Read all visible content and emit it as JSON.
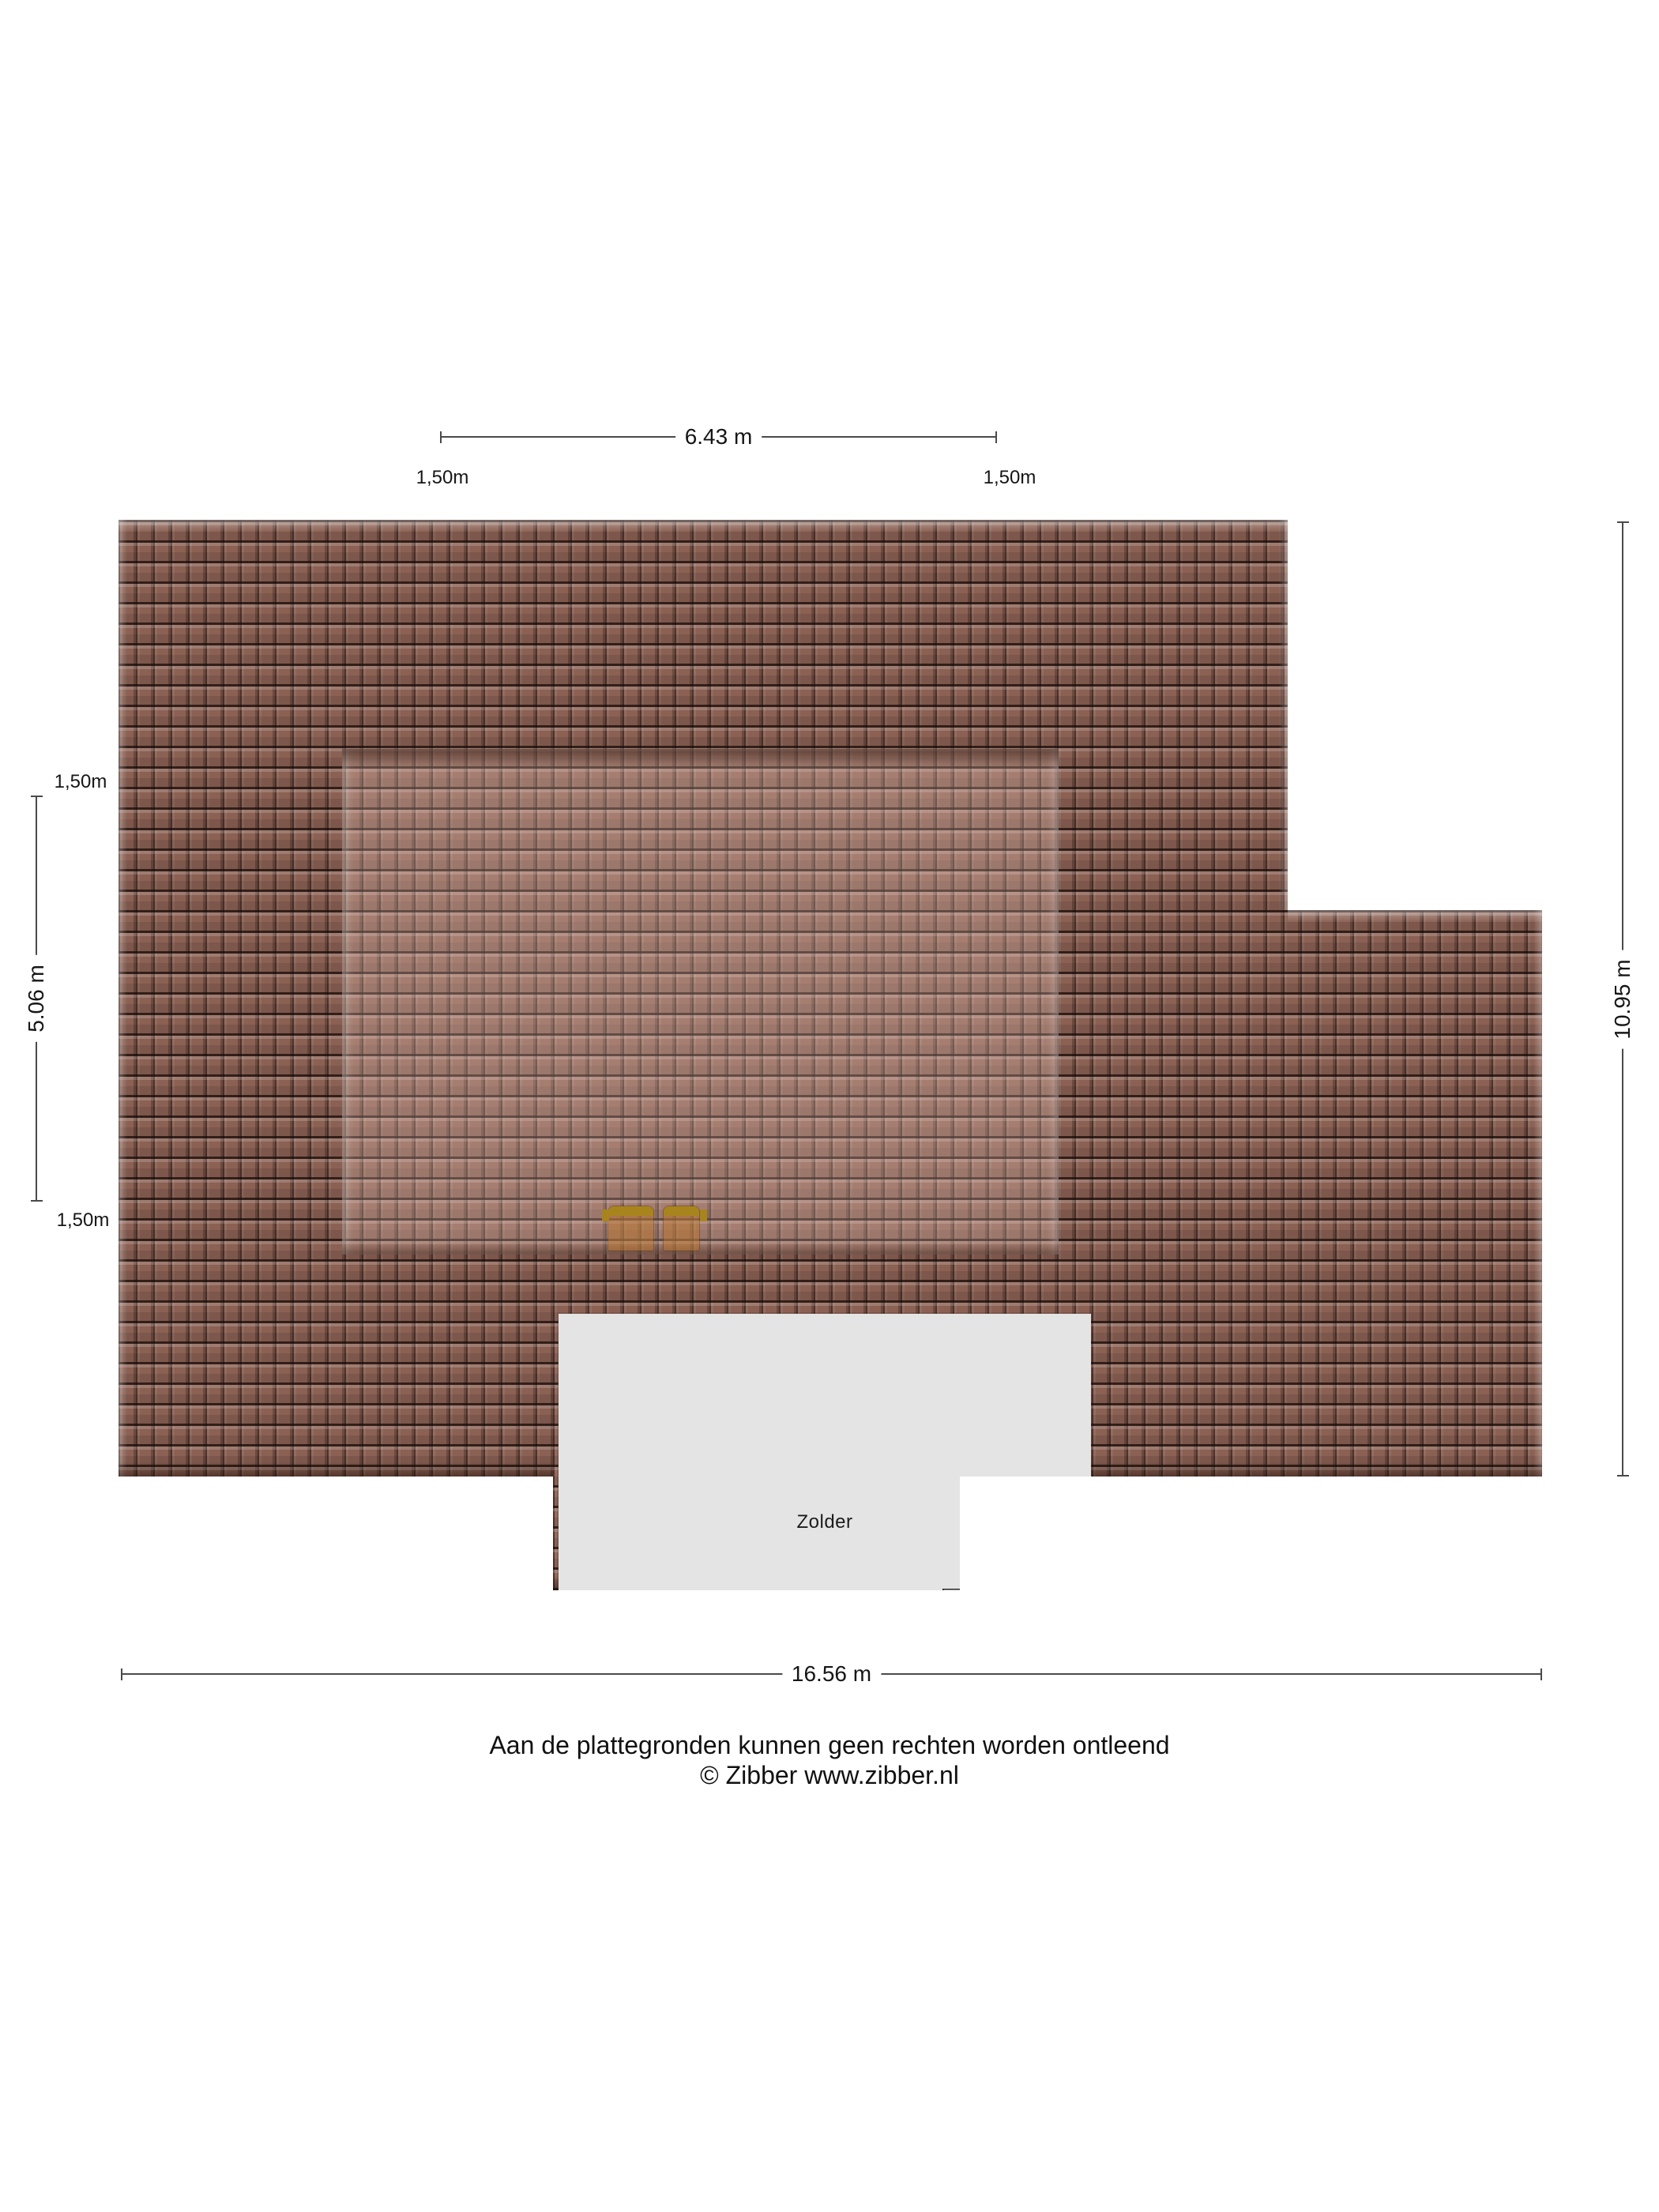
{
  "plan": {
    "room_label": "Zolder",
    "colors": {
      "tile_base": "#8b6154",
      "tile_gap_dark": "#2e1a13",
      "dormer_tint": "rgba(255,223,208,0.24)",
      "room_fill": "#e4e4e4",
      "furniture_gold": "#a8841c",
      "furniture_body": "rgba(187,118,42,0.48)",
      "dimension_line": "#4a4a4a",
      "text": "#1c1c1c"
    }
  },
  "dimensions": {
    "top": {
      "label": "6.43 m",
      "left_sub": "1,50m",
      "right_sub": "1,50m"
    },
    "left": {
      "label": "5.06 m",
      "top_sub": "1,50m",
      "bottom_sub": "1,50m"
    },
    "right": {
      "label": "10.95 m"
    },
    "bottom": {
      "label": "16.56 m"
    }
  },
  "footer": {
    "line1": "Aan de plattegronden kunnen geen rechten worden ontleend",
    "line2": "© Zibber www.zibber.nl"
  }
}
